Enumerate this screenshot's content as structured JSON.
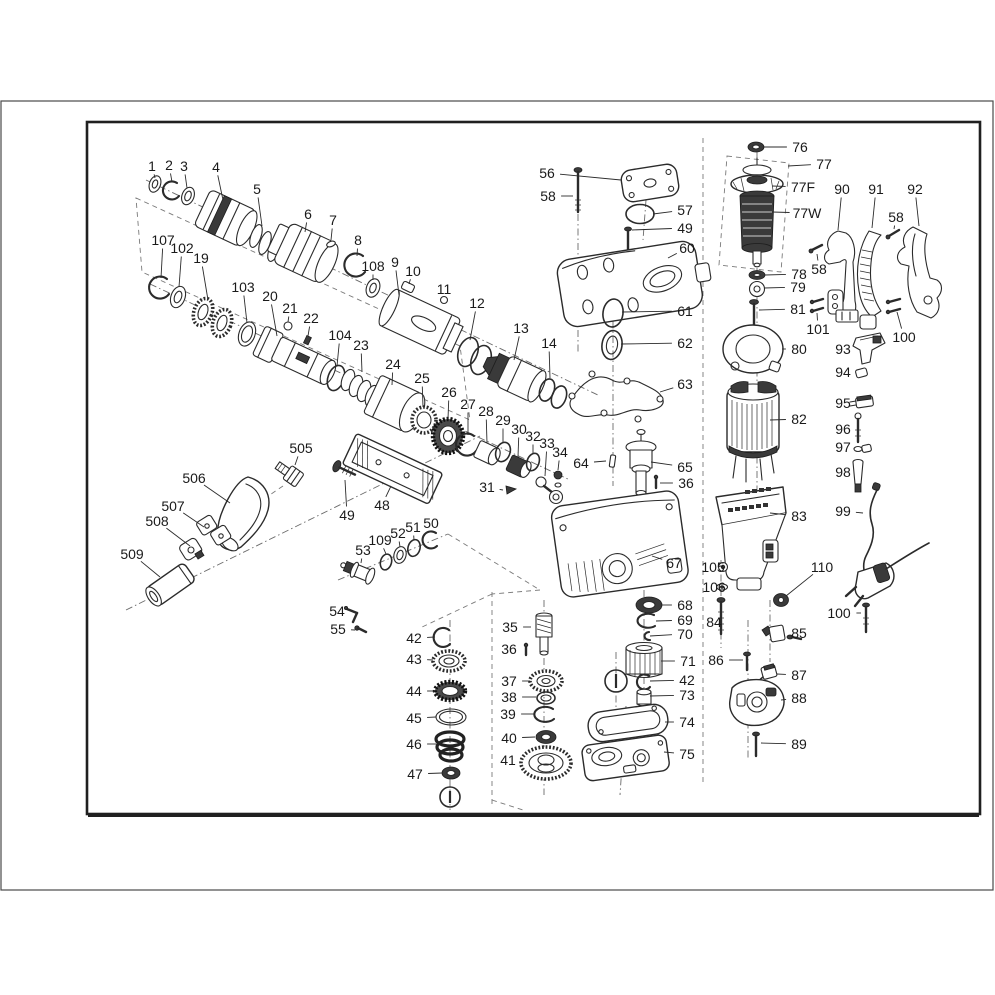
{
  "figure": {
    "kind": "exploded-parts-diagram",
    "line_color": "#2b2b2b",
    "label_color": "#1a1a1a",
    "background": "#ffffff"
  },
  "labels": [
    {
      "t": "1",
      "x": 152,
      "y": 166,
      "ex": 155,
      "ey": 178
    },
    {
      "t": "2",
      "x": 169,
      "y": 165,
      "ex": 172,
      "ey": 182
    },
    {
      "t": "3",
      "x": 184,
      "y": 166,
      "ex": 187,
      "ey": 188
    },
    {
      "t": "4",
      "x": 216,
      "y": 167,
      "ex": 223,
      "ey": 200
    },
    {
      "t": "5",
      "x": 257,
      "y": 189,
      "ex": 262,
      "ey": 226
    },
    {
      "t": "6",
      "x": 308,
      "y": 214,
      "ex": 305,
      "ey": 232
    },
    {
      "t": "7",
      "x": 333,
      "y": 220,
      "ex": 331,
      "ey": 240
    },
    {
      "t": "8",
      "x": 358,
      "y": 240,
      "ex": 357,
      "ey": 256
    },
    {
      "t": "107",
      "x": 163,
      "y": 240,
      "ex": 161,
      "ey": 278
    },
    {
      "t": "102",
      "x": 182,
      "y": 248,
      "ex": 179,
      "ey": 287
    },
    {
      "t": "19",
      "x": 201,
      "y": 258,
      "ex": 208,
      "ey": 300
    },
    {
      "t": "103",
      "x": 243,
      "y": 287,
      "ex": 247,
      "ey": 323
    },
    {
      "t": "20",
      "x": 270,
      "y": 296,
      "ex": 277,
      "ey": 336
    },
    {
      "t": "21",
      "x": 290,
      "y": 308,
      "ex": 288,
      "ey": 322
    },
    {
      "t": "22",
      "x": 311,
      "y": 318,
      "ex": 308,
      "ey": 336
    },
    {
      "t": "104",
      "x": 340,
      "y": 335,
      "ex": 337,
      "ey": 366
    },
    {
      "t": "23",
      "x": 361,
      "y": 345,
      "ex": 362,
      "ey": 372
    },
    {
      "t": "108",
      "x": 373,
      "y": 266,
      "ex": 373,
      "ey": 280
    },
    {
      "t": "9",
      "x": 395,
      "y": 262,
      "ex": 399,
      "ey": 295
    },
    {
      "t": "10",
      "x": 413,
      "y": 271,
      "ex": 409,
      "ey": 284
    },
    {
      "t": "11",
      "x": 444,
      "y": 289,
      "ex": 444,
      "ey": 296
    },
    {
      "t": "12",
      "x": 477,
      "y": 303,
      "ex": 470,
      "ey": 340
    },
    {
      "t": "13",
      "x": 521,
      "y": 328,
      "ex": 514,
      "ey": 360
    },
    {
      "t": "14",
      "x": 549,
      "y": 343,
      "ex": 550,
      "ey": 378
    },
    {
      "t": "24",
      "x": 393,
      "y": 364,
      "ex": 392,
      "ey": 385
    },
    {
      "t": "25",
      "x": 422,
      "y": 378,
      "ex": 423,
      "ey": 407
    },
    {
      "t": "26",
      "x": 449,
      "y": 392,
      "ex": 448,
      "ey": 419
    },
    {
      "t": "27",
      "x": 468,
      "y": 404,
      "ex": 468,
      "ey": 435
    },
    {
      "t": "28",
      "x": 486,
      "y": 411,
      "ex": 487,
      "ey": 443
    },
    {
      "t": "29",
      "x": 503,
      "y": 420,
      "ex": 503,
      "ey": 442
    },
    {
      "t": "30",
      "x": 519,
      "y": 429,
      "ex": 518,
      "ey": 457
    },
    {
      "t": "32",
      "x": 533,
      "y": 436,
      "ex": 533,
      "ey": 453
    },
    {
      "t": "33",
      "x": 547,
      "y": 443,
      "ex": 545,
      "ey": 476
    },
    {
      "t": "34",
      "x": 560,
      "y": 452,
      "ex": 558,
      "ey": 470
    },
    {
      "t": "31",
      "x": 487,
      "y": 487,
      "ex": 503,
      "ey": 490
    },
    {
      "t": "48",
      "x": 382,
      "y": 505,
      "ex": 391,
      "ey": 486
    },
    {
      "t": "49",
      "x": 347,
      "y": 515,
      "ex": 345,
      "ey": 480
    },
    {
      "t": "505",
      "x": 301,
      "y": 448,
      "ex": 295,
      "ey": 465
    },
    {
      "t": "506",
      "x": 194,
      "y": 478,
      "ex": 230,
      "ey": 503
    },
    {
      "t": "507",
      "x": 173,
      "y": 506,
      "ex": 204,
      "ey": 527
    },
    {
      "t": "508",
      "x": 157,
      "y": 521,
      "ex": 190,
      "ey": 546
    },
    {
      "t": "509",
      "x": 132,
      "y": 554,
      "ex": 160,
      "ey": 577
    },
    {
      "t": "53",
      "x": 363,
      "y": 550,
      "ex": 361,
      "ey": 563
    },
    {
      "t": "109",
      "x": 380,
      "y": 540,
      "ex": 386,
      "ey": 554
    },
    {
      "t": "52",
      "x": 398,
      "y": 533,
      "ex": 400,
      "ey": 547
    },
    {
      "t": "51",
      "x": 413,
      "y": 527,
      "ex": 414,
      "ey": 540
    },
    {
      "t": "50",
      "x": 431,
      "y": 523,
      "ex": 431,
      "ey": 532
    },
    {
      "t": "54",
      "x": 337,
      "y": 611,
      "ex": 348,
      "ey": 612
    },
    {
      "t": "55",
      "x": 338,
      "y": 629,
      "ex": 355,
      "ey": 630
    },
    {
      "t": "42",
      "x": 414,
      "y": 638,
      "ex": 435,
      "ey": 637
    },
    {
      "t": "43",
      "x": 414,
      "y": 659,
      "ex": 433,
      "ey": 660
    },
    {
      "t": "44",
      "x": 414,
      "y": 691,
      "ex": 435,
      "ey": 691
    },
    {
      "t": "45",
      "x": 414,
      "y": 718,
      "ex": 436,
      "ey": 717
    },
    {
      "t": "46",
      "x": 414,
      "y": 744,
      "ex": 436,
      "ey": 744
    },
    {
      "t": "47",
      "x": 415,
      "y": 774,
      "ex": 442,
      "ey": 773
    },
    {
      "t": "35",
      "x": 510,
      "y": 627,
      "ex": 531,
      "ey": 627
    },
    {
      "t": "36",
      "x": 509,
      "y": 649,
      "ex": 522,
      "ey": 650
    },
    {
      "t": "37",
      "x": 509,
      "y": 681,
      "ex": 530,
      "ey": 681
    },
    {
      "t": "38",
      "x": 509,
      "y": 697,
      "ex": 536,
      "ey": 697
    },
    {
      "t": "39",
      "x": 508,
      "y": 714,
      "ex": 534,
      "ey": 714
    },
    {
      "t": "40",
      "x": 509,
      "y": 738,
      "ex": 535,
      "ey": 737
    },
    {
      "t": "41",
      "x": 508,
      "y": 760,
      "ex": 521,
      "ey": 761
    },
    {
      "t": "68",
      "x": 685,
      "y": 605,
      "ex": 661,
      "ey": 605
    },
    {
      "t": "69",
      "x": 685,
      "y": 620,
      "ex": 656,
      "ey": 621
    },
    {
      "t": "70",
      "x": 685,
      "y": 634,
      "ex": 650,
      "ey": 636
    },
    {
      "t": "71",
      "x": 688,
      "y": 661,
      "ex": 661,
      "ey": 661
    },
    {
      "t": "42",
      "x": 687,
      "y": 680,
      "ex": 650,
      "ey": 681
    },
    {
      "t": "73",
      "x": 687,
      "y": 695,
      "ex": 650,
      "ey": 696
    },
    {
      "t": "74",
      "x": 687,
      "y": 722,
      "ex": 665,
      "ey": 722
    },
    {
      "t": "75",
      "x": 687,
      "y": 754,
      "ex": 664,
      "ey": 752
    },
    {
      "t": "56",
      "x": 547,
      "y": 173,
      "ex": 621,
      "ey": 180
    },
    {
      "t": "58",
      "x": 548,
      "y": 196,
      "ex": 573,
      "ey": 196
    },
    {
      "t": "57",
      "x": 685,
      "y": 210,
      "ex": 653,
      "ey": 214
    },
    {
      "t": "49",
      "x": 685,
      "y": 228,
      "ex": 632,
      "ey": 230
    },
    {
      "t": "60",
      "x": 687,
      "y": 248,
      "ex": 668,
      "ey": 258
    },
    {
      "t": "61",
      "x": 685,
      "y": 311,
      "ex": 622,
      "ey": 312
    },
    {
      "t": "62",
      "x": 685,
      "y": 343,
      "ex": 621,
      "ey": 344
    },
    {
      "t": "63",
      "x": 685,
      "y": 384,
      "ex": 660,
      "ey": 392
    },
    {
      "t": "64",
      "x": 581,
      "y": 463,
      "ex": 606,
      "ey": 461
    },
    {
      "t": "65",
      "x": 685,
      "y": 467,
      "ex": 651,
      "ey": 462
    },
    {
      "t": "36",
      "x": 686,
      "y": 483,
      "ex": 660,
      "ey": 483
    },
    {
      "t": "67",
      "x": 674,
      "y": 563,
      "ex": 652,
      "ey": 556
    },
    {
      "t": "76",
      "x": 800,
      "y": 147,
      "ex": 764,
      "ey": 147
    },
    {
      "t": "77",
      "x": 824,
      "y": 164,
      "ex": 788,
      "ey": 166
    },
    {
      "t": "77F",
      "x": 803,
      "y": 187,
      "ex": 772,
      "ey": 186
    },
    {
      "t": "77W",
      "x": 807,
      "y": 213,
      "ex": 772,
      "ey": 212
    },
    {
      "t": "78",
      "x": 799,
      "y": 274,
      "ex": 765,
      "ey": 275
    },
    {
      "t": "79",
      "x": 798,
      "y": 287,
      "ex": 764,
      "ey": 288
    },
    {
      "t": "81",
      "x": 798,
      "y": 309,
      "ex": 759,
      "ey": 310
    },
    {
      "t": "80",
      "x": 799,
      "y": 349,
      "ex": 782,
      "ey": 349
    },
    {
      "t": "82",
      "x": 799,
      "y": 419,
      "ex": 770,
      "ey": 420
    },
    {
      "t": "83",
      "x": 799,
      "y": 516,
      "ex": 770,
      "ey": 513
    },
    {
      "t": "90",
      "x": 842,
      "y": 189,
      "ex": 838,
      "ey": 230
    },
    {
      "t": "91",
      "x": 876,
      "y": 189,
      "ex": 872,
      "ey": 228
    },
    {
      "t": "92",
      "x": 915,
      "y": 189,
      "ex": 919,
      "ey": 226
    },
    {
      "t": "58",
      "x": 896,
      "y": 217,
      "ex": 894,
      "ey": 229
    },
    {
      "t": "58",
      "x": 819,
      "y": 269,
      "ex": 817,
      "ey": 254
    },
    {
      "t": "101",
      "x": 818,
      "y": 329,
      "ex": 817,
      "ey": 313
    },
    {
      "t": "100",
      "x": 904,
      "y": 337,
      "ex": 897,
      "ey": 312
    },
    {
      "t": "93",
      "x": 843,
      "y": 349,
      "ex": 857,
      "ey": 348
    },
    {
      "t": "94",
      "x": 843,
      "y": 372,
      "ex": 856,
      "ey": 373
    },
    {
      "t": "95",
      "x": 843,
      "y": 403,
      "ex": 855,
      "ey": 402
    },
    {
      "t": "96",
      "x": 843,
      "y": 429,
      "ex": 854,
      "ey": 429
    },
    {
      "t": "97",
      "x": 843,
      "y": 447,
      "ex": 855,
      "ey": 448
    },
    {
      "t": "98",
      "x": 843,
      "y": 472,
      "ex": 852,
      "ey": 471
    },
    {
      "t": "99",
      "x": 843,
      "y": 511,
      "ex": 863,
      "ey": 513
    },
    {
      "t": "105",
      "x": 713,
      "y": 567,
      "ex": 719,
      "ey": 567
    },
    {
      "t": "106",
      "x": 714,
      "y": 587,
      "ex": 717,
      "ey": 587
    },
    {
      "t": "84",
      "x": 714,
      "y": 622,
      "ex": 717,
      "ey": 618
    },
    {
      "t": "86",
      "x": 716,
      "y": 660,
      "ex": 743,
      "ey": 660
    },
    {
      "t": "85",
      "x": 799,
      "y": 633,
      "ex": 784,
      "ey": 634
    },
    {
      "t": "87",
      "x": 799,
      "y": 675,
      "ex": 777,
      "ey": 674
    },
    {
      "t": "88",
      "x": 799,
      "y": 698,
      "ex": 781,
      "ey": 700
    },
    {
      "t": "89",
      "x": 799,
      "y": 744,
      "ex": 761,
      "ey": 743
    },
    {
      "t": "110",
      "x": 822,
      "y": 567,
      "ex": 786,
      "ey": 596
    },
    {
      "t": "100",
      "x": 839,
      "y": 613,
      "ex": 861,
      "ey": 613
    }
  ]
}
